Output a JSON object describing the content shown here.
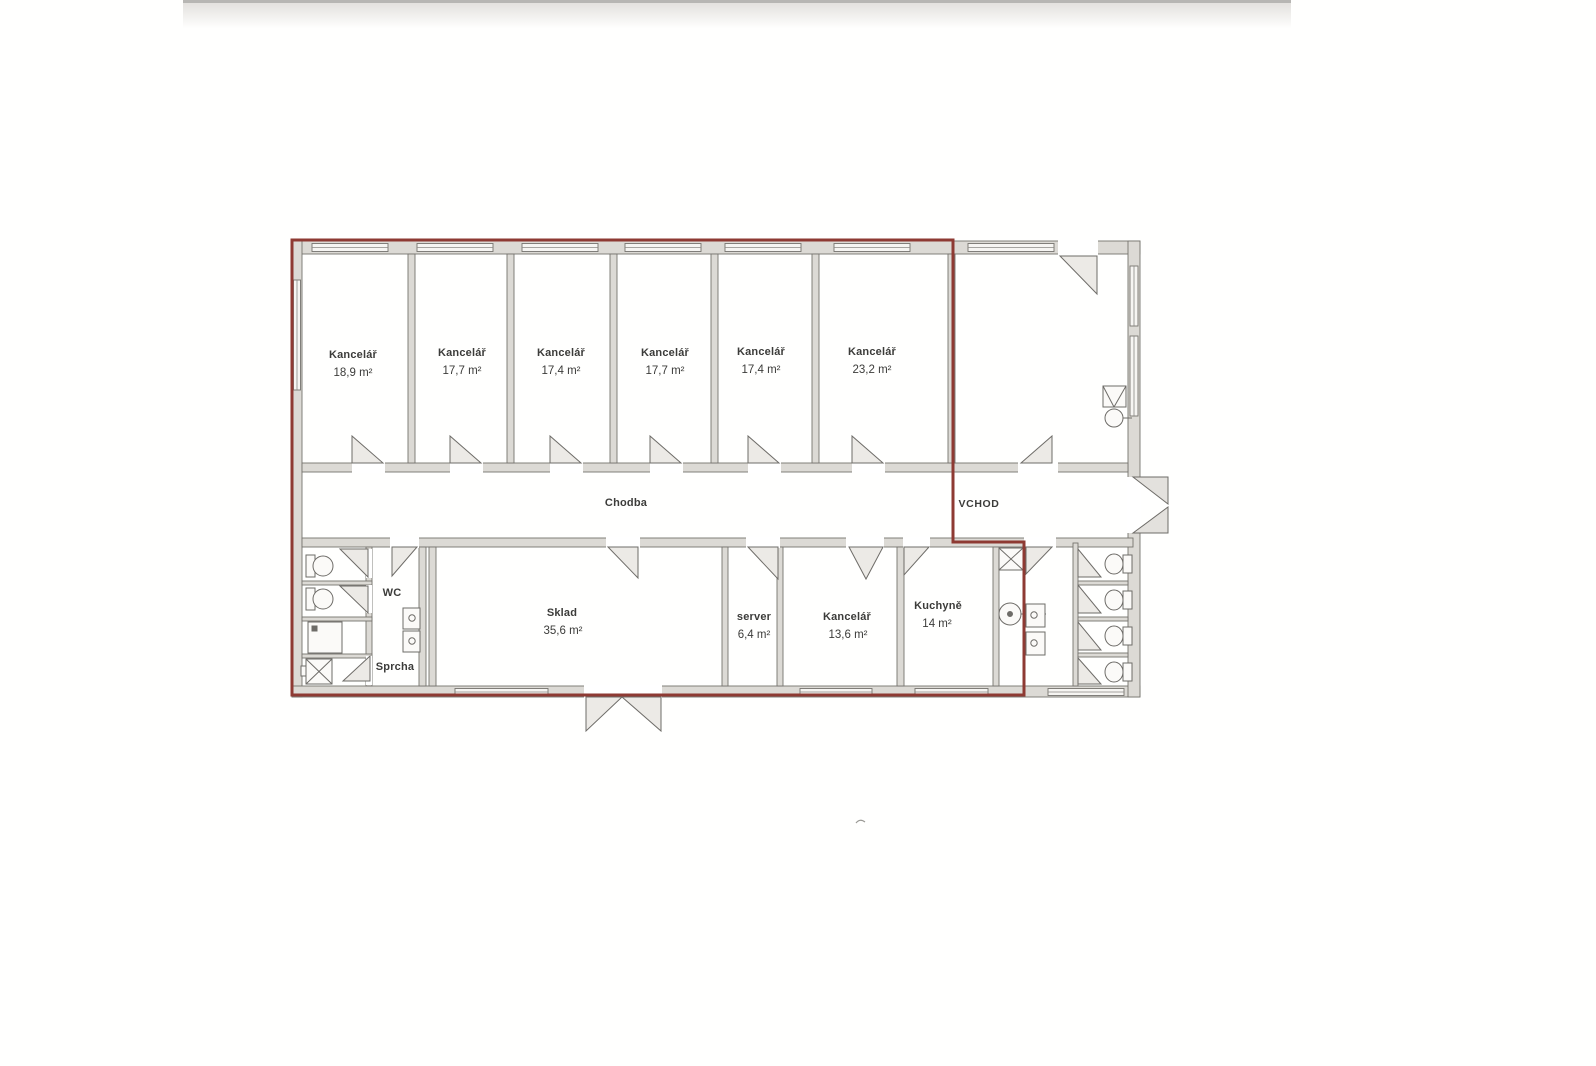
{
  "plan": {
    "rooms": {
      "office1": {
        "name": "Kancelář",
        "area": "18,9 m²"
      },
      "office2": {
        "name": "Kancelář",
        "area": "17,7 m²"
      },
      "office3": {
        "name": "Kancelář",
        "area": "17,4 m²"
      },
      "office4": {
        "name": "Kancelář",
        "area": "17,7 m²"
      },
      "office5": {
        "name": "Kancelář",
        "area": "17,4 m²"
      },
      "office6": {
        "name": "Kancelář",
        "area": "23,2 m²"
      },
      "corridor": {
        "name": "Chodba"
      },
      "entrance": {
        "name": "VCHOD"
      },
      "wc": {
        "name": "WC"
      },
      "shower": {
        "name": "Sprcha"
      },
      "storage": {
        "name": "Sklad",
        "area": "35,6 m²"
      },
      "server": {
        "name": "server",
        "area": "6,4 m²"
      },
      "office7": {
        "name": "Kancelář",
        "area": "13,6 m²"
      },
      "kitchen": {
        "name": "Kuchyně",
        "area": "14 m²"
      }
    },
    "colors": {
      "lease_outline": "#8e3a33",
      "wall_fill": "#dcdad5",
      "wall_line": "#75736e",
      "text": "#3c3c3a"
    }
  }
}
